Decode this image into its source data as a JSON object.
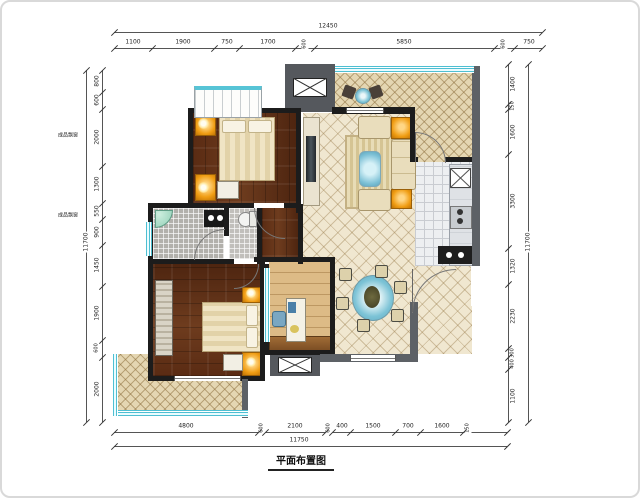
{
  "title": {
    "text": "平面布置图"
  },
  "annotations": {
    "bay_window_top": "成品飘窗",
    "bay_window_bottom": "成品飘窗"
  },
  "dimensions": {
    "top": {
      "total": "12450",
      "segments": [
        "1100",
        "1900",
        "750",
        "1700",
        "600",
        "5850",
        "600",
        "750"
      ]
    },
    "bottom": {
      "total": "11750",
      "segments": [
        "4800",
        "600",
        "2100",
        "600",
        "400",
        "1500",
        "700",
        "1600",
        "150"
      ]
    },
    "left": {
      "total": "11700",
      "segments": [
        "800",
        "600",
        "2000",
        "1300",
        "550",
        "900",
        "1450",
        "1900",
        "600",
        "2000"
      ]
    },
    "right": {
      "total": "11700",
      "segments": [
        "1400",
        "150",
        "1600",
        "3300",
        "1320",
        "2230",
        "300",
        "400",
        "1100"
      ]
    }
  },
  "colors": {
    "interior_wall": "#1c1c1c",
    "exterior_wall": "#5d6166",
    "wood_dark": "#5a2b13",
    "wood_light": "#ddbb86",
    "tile_cream": "#f0e7d0",
    "glazing_teal": "#4ebfd2",
    "accent_orange": "#f09d13",
    "water_blue": "#7cc3d6"
  }
}
